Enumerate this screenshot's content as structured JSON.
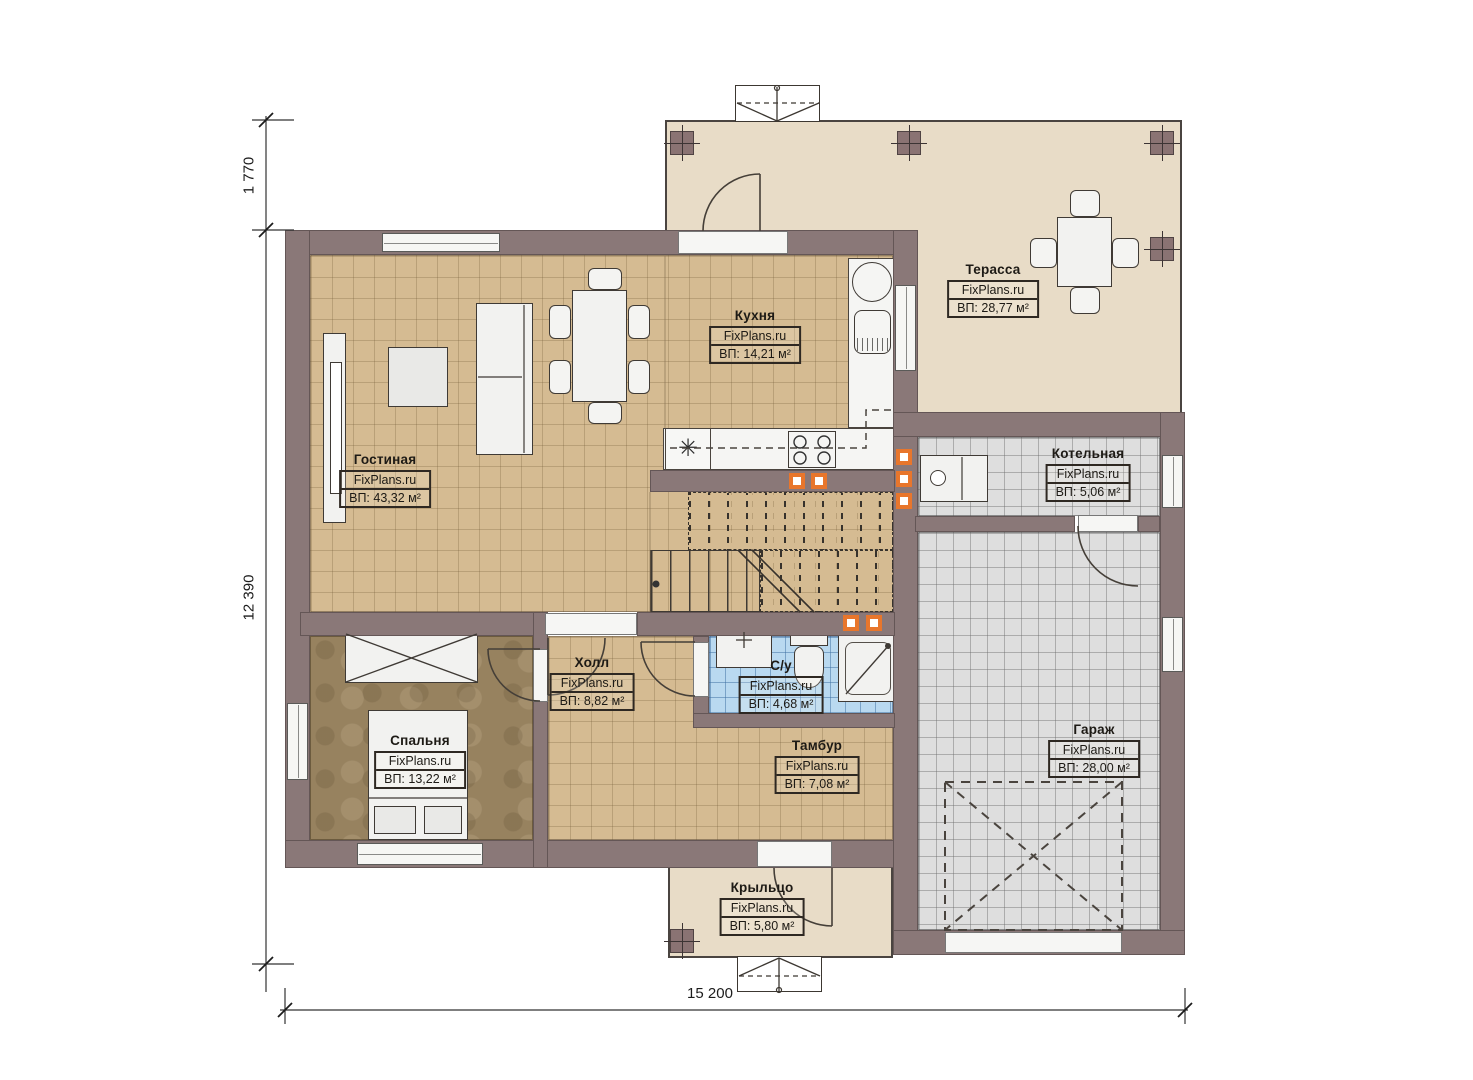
{
  "brand": "FixPlans.ru",
  "rooms": {
    "living": {
      "name": "Гостиная",
      "brand": "FixPlans.ru",
      "area": "ВП: 43,32 м²"
    },
    "kitchen": {
      "name": "Кухня",
      "brand": "FixPlans.ru",
      "area": "ВП: 14,21 м²"
    },
    "terrace": {
      "name": "Терасса",
      "brand": "FixPlans.ru",
      "area": "ВП: 28,77 м²"
    },
    "boiler": {
      "name": "Котельная",
      "brand": "FixPlans.ru",
      "area": "ВП: 5,06 м²"
    },
    "garage": {
      "name": "Гараж",
      "brand": "FixPlans.ru",
      "area": "ВП: 28,00 м²"
    },
    "hall": {
      "name": "Холл",
      "brand": "FixPlans.ru",
      "area": "ВП: 8,82 м²"
    },
    "bath": {
      "name": "С/у",
      "brand": "FixPlans.ru",
      "area": "ВП: 4,68 м²"
    },
    "bedroom": {
      "name": "Спальня",
      "brand": "FixPlans.ru",
      "area": "ВП: 13,22 м²"
    },
    "vestibule": {
      "name": "Тамбур",
      "brand": "FixPlans.ru",
      "area": "ВП: 7,08 м²"
    },
    "porch": {
      "name": "Крыльцо",
      "brand": "FixPlans.ru",
      "area": "ВП: 5,80 м²"
    }
  },
  "dimensions": {
    "terrace_depth": "1 770",
    "house_height": "12 390",
    "house_width": "15 200"
  },
  "icons": {
    "appliance_star": "✳"
  },
  "colors": {
    "wall": "#8a7878",
    "floor_tile_tan": "#d5bb92",
    "floor_terrace": "#e8dcc7",
    "floor_bedroom": "#97825f",
    "floor_bath": "#b9d9f0",
    "floor_garage": "#dedede",
    "accent_marker": "#e8762c"
  }
}
